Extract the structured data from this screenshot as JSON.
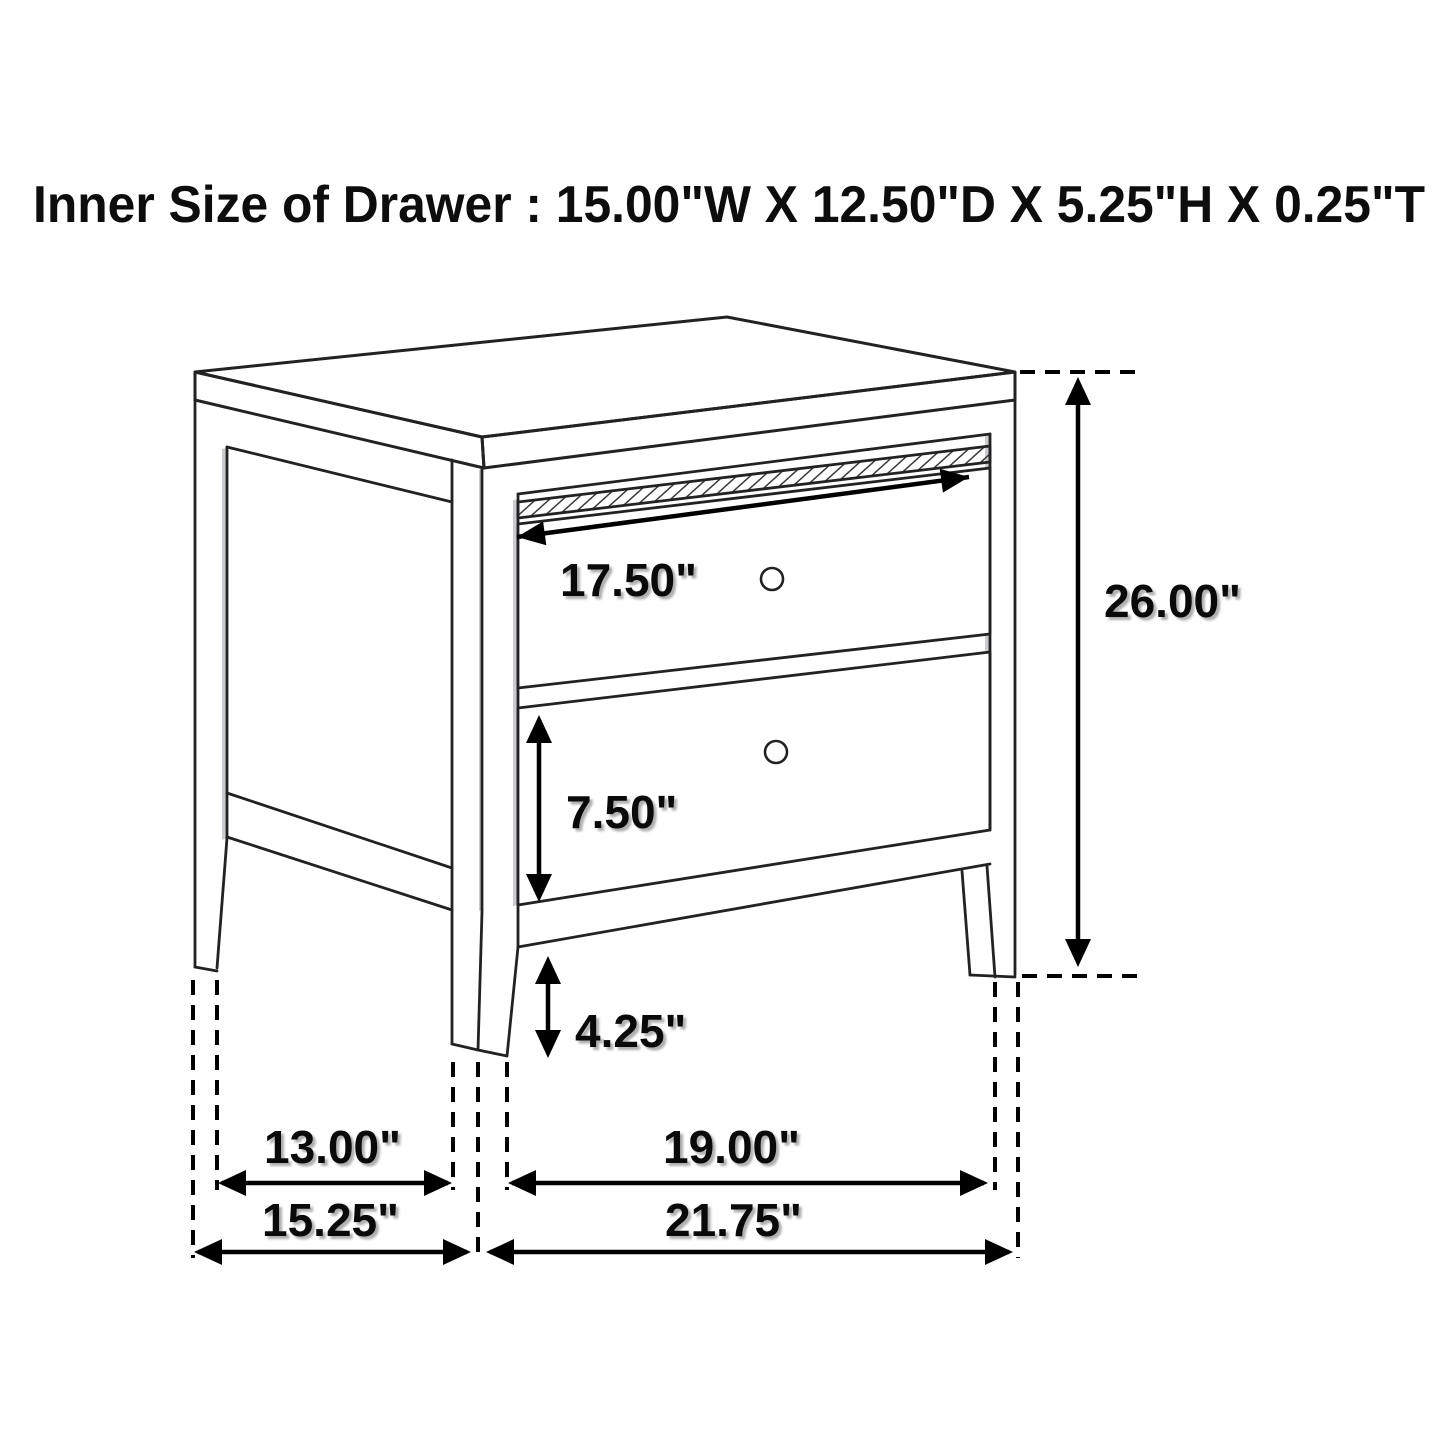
{
  "title": "Inner Size of Drawer : 15.00\"W X 12.50\"D X 5.25\"H X 0.25\"T",
  "drawing": {
    "object": "two-drawer nightstand dimension diagram",
    "view": "three-quarter perspective line drawing",
    "drawer_count": 2
  },
  "dimensions": {
    "drawer_face_width": "17.50\"",
    "overall_height": "26.00\"",
    "bottom_drawer_height": "7.50\"",
    "leg_height": "4.25\"",
    "side_leg_spacing": "13.00\"",
    "overall_depth": "15.25\"",
    "front_leg_spacing": "19.00\"",
    "overall_width": "21.75\""
  },
  "colors": {
    "line": "#222222",
    "dimension": "#000000",
    "shading": "#b9b9bf",
    "background": "#ffffff"
  }
}
